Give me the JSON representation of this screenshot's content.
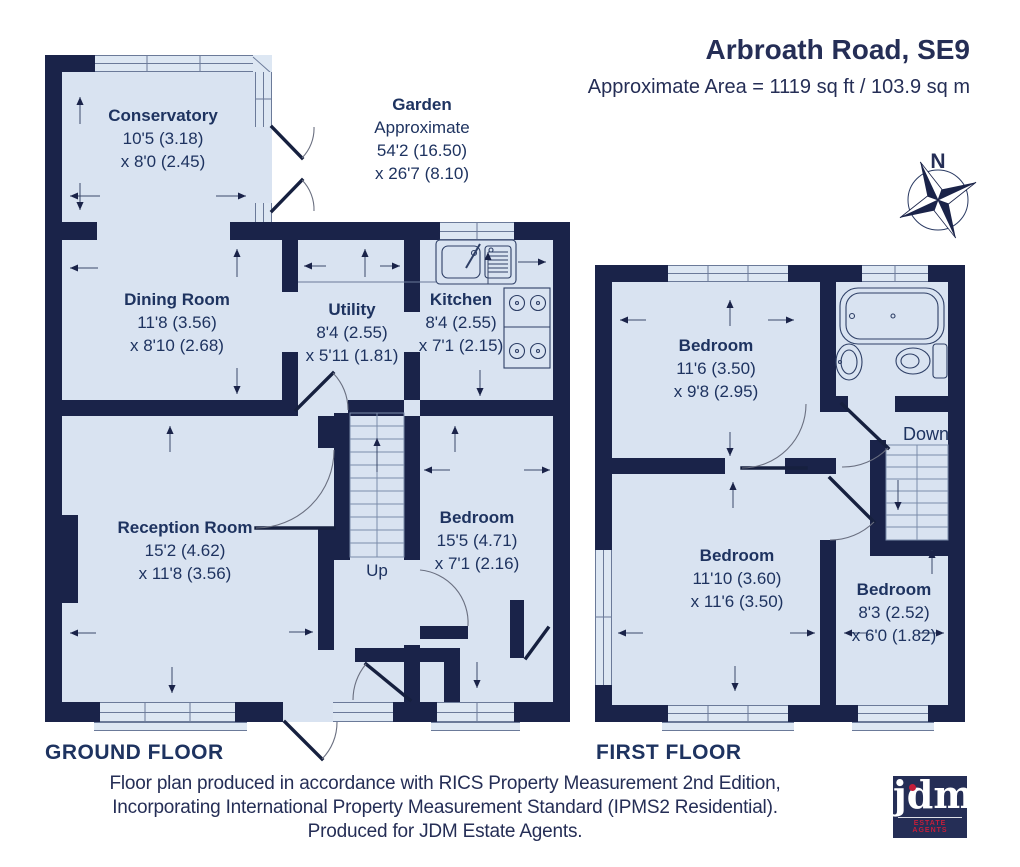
{
  "header": {
    "title": "Arbroath Road, SE9",
    "subtitle": "Approximate Area = 1119 sq ft / 103.9 sq m"
  },
  "compass": {
    "north_label": "N"
  },
  "ground_floor": {
    "label": "GROUND FLOOR",
    "stairs_label": "Up",
    "rooms": {
      "conservatory": {
        "name": "Conservatory",
        "dim1": "10'5 (3.18)",
        "dim2": "x 8'0 (2.45)"
      },
      "garden": {
        "name": "Garden",
        "note": "Approximate",
        "dim1": "54'2 (16.50)",
        "dim2": "x 26'7 (8.10)"
      },
      "dining_room": {
        "name": "Dining Room",
        "dim1": "11'8 (3.56)",
        "dim2": "x 8'10 (2.68)"
      },
      "utility": {
        "name": "Utility",
        "dim1": "8'4 (2.55)",
        "dim2": "x 5'11 (1.81)"
      },
      "kitchen": {
        "name": "Kitchen",
        "dim1": "8'4 (2.55)",
        "dim2": "x 7'1 (2.15)"
      },
      "reception_room": {
        "name": "Reception Room",
        "dim1": "15'2 (4.62)",
        "dim2": "x 11'8 (3.56)"
      },
      "bedroom": {
        "name": "Bedroom",
        "dim1": "15'5 (4.71)",
        "dim2": "x 7'1 (2.16)"
      }
    }
  },
  "first_floor": {
    "label": "FIRST FLOOR",
    "stairs_label": "Down",
    "rooms": {
      "bedroom_front": {
        "name": "Bedroom",
        "dim1": "11'6 (3.50)",
        "dim2": "x 9'8 (2.95)"
      },
      "bedroom_rear": {
        "name": "Bedroom",
        "dim1": "11'10 (3.60)",
        "dim2": "x 11'6 (3.50)"
      },
      "bedroom_small": {
        "name": "Bedroom",
        "dim1": "8'3 (2.52)",
        "dim2": "x 6'0 (1.82)"
      }
    }
  },
  "footer": {
    "lines": [
      "Floor plan produced in accordance with RICS Property Measurement 2nd Edition,",
      "Incorporating International Property Measurement Standard (IPMS2 Residential).",
      "Produced for JDM Estate Agents."
    ]
  },
  "logo": {
    "name": "jdm",
    "tagline": "ESTATE AGENTS"
  },
  "colors": {
    "wall": "#1a2349",
    "room_fill": "#d9e3f1",
    "text": "#1e3360",
    "logo_red": "#c41e3a"
  }
}
